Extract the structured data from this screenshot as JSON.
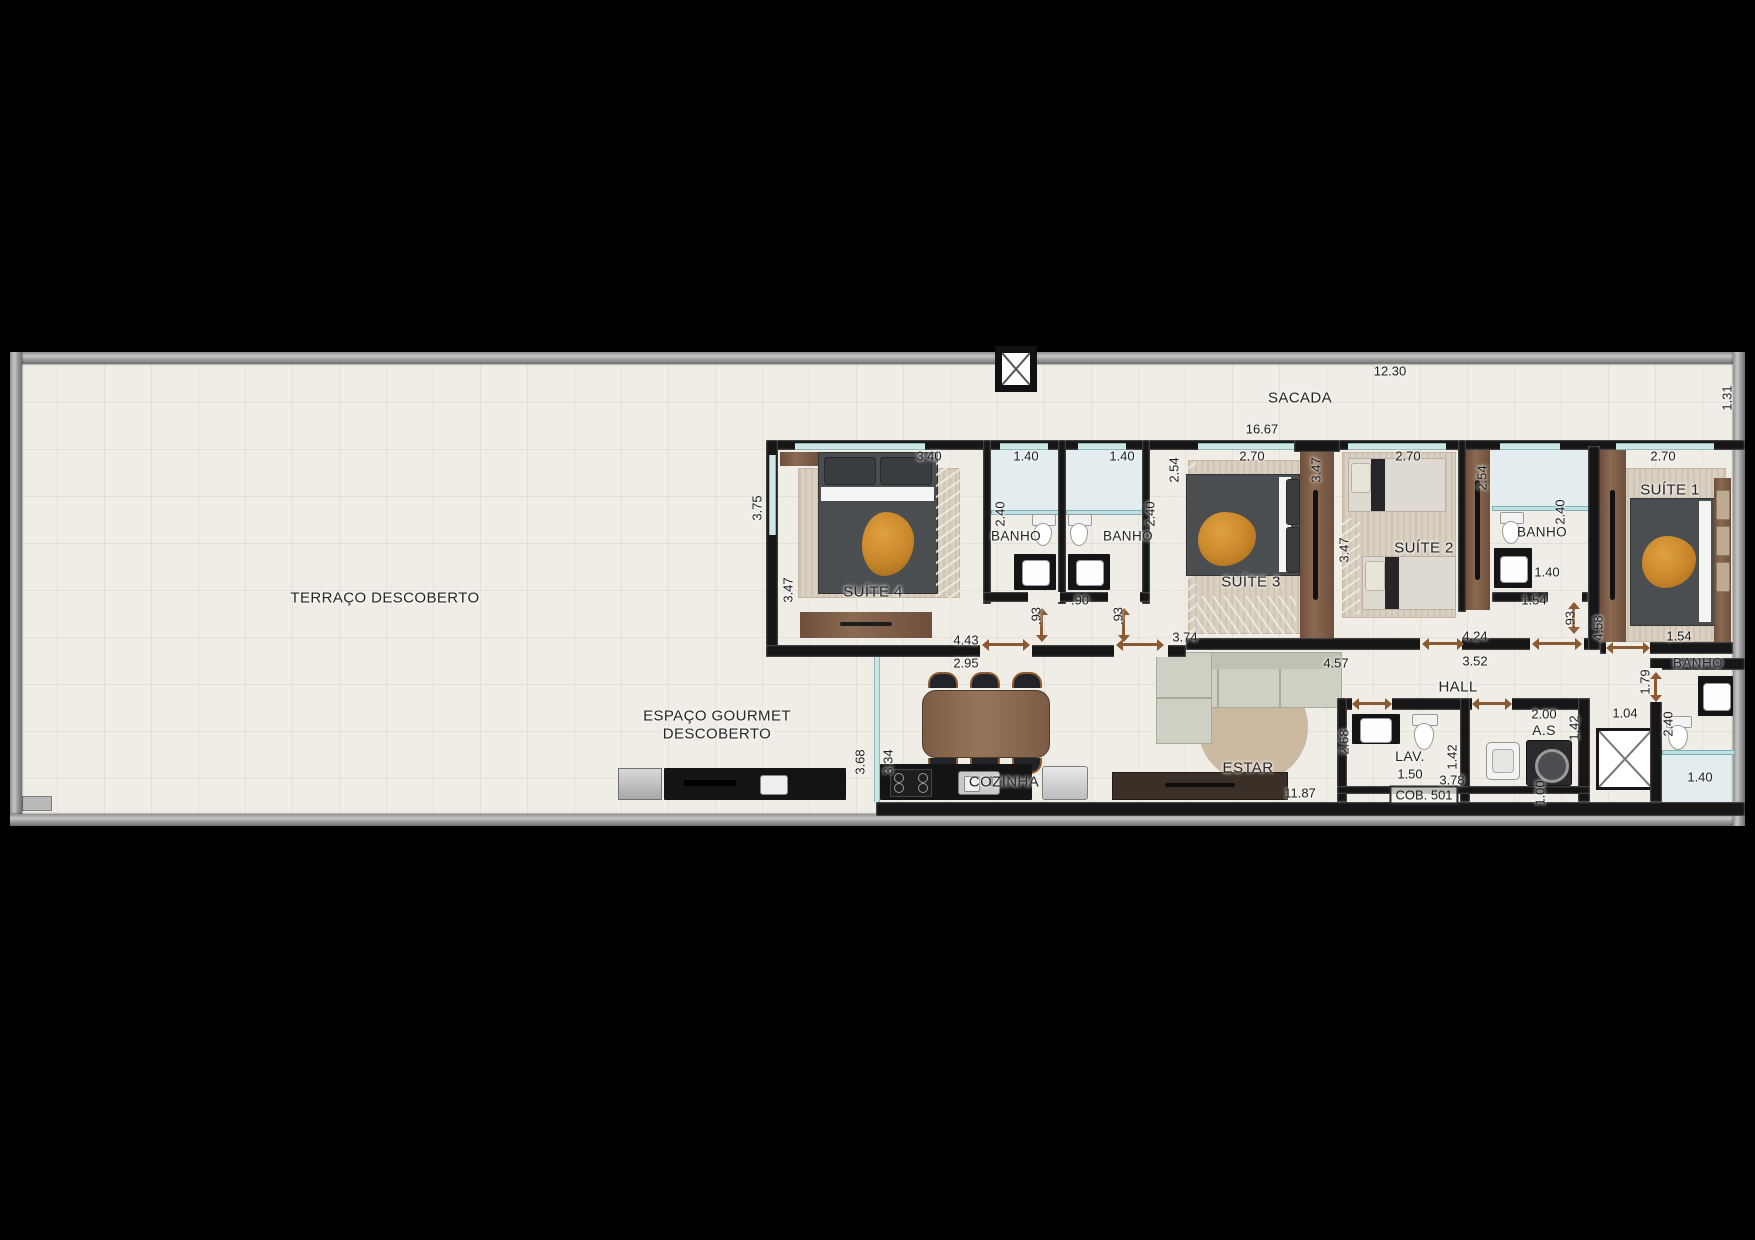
{
  "unit_label": "COB. 501",
  "rooms": {
    "terraco": "TERRAÇO DESCOBERTO",
    "sacada": "SACADA",
    "gourmet1": "ESPAÇO GOURMET",
    "gourmet2": "DESCOBERTO",
    "cozinha": "COZINHA",
    "estar": "ESTAR",
    "hall": "HALL",
    "lav": "LAV.",
    "as": "A.S",
    "banho": "BANHO",
    "suite1": "SUÍTE 1",
    "suite2": "SUÍTE 2",
    "suite3": "SUÍTE 3",
    "suite4": "SUÍTE 4"
  },
  "dims": [
    {
      "id": "sacada_len",
      "value": "12.30"
    },
    {
      "id": "sacada_depth",
      "value": "1.31"
    },
    {
      "id": "apt_width",
      "value": "16.67"
    },
    {
      "id": "s4_w",
      "value": "3.40"
    },
    {
      "id": "b1_w",
      "value": "1.40"
    },
    {
      "id": "b2_w",
      "value": "1.40"
    },
    {
      "id": "s3_w",
      "value": "2.70"
    },
    {
      "id": "s2_w",
      "value": "2.70"
    },
    {
      "id": "s1_w",
      "value": "2.70"
    },
    {
      "id": "b2_wall",
      "value": "2.54"
    },
    {
      "id": "s3_wall",
      "value": "3.47"
    },
    {
      "id": "b3_wall",
      "value": "2.54"
    },
    {
      "id": "s4_d1",
      "value": "3.75"
    },
    {
      "id": "s4_d2",
      "value": "3.47"
    },
    {
      "id": "b1_d",
      "value": "2.40"
    },
    {
      "id": "b2_d",
      "value": "2.40"
    },
    {
      "id": "b3_d",
      "value": "2.40"
    },
    {
      "id": "b3_w2",
      "value": "1.40"
    },
    {
      "id": "s2_wall",
      "value": "3.47"
    },
    {
      "id": "b3_s",
      "value": "1.54"
    },
    {
      "id": "s1_door",
      "value": ".93"
    },
    {
      "id": "wall_458",
      "value": "4.58"
    },
    {
      "id": "s1_s",
      "value": "1.54"
    },
    {
      "id": "br_wall",
      "value": "1.79"
    },
    {
      "id": "br_d",
      "value": "2.40"
    },
    {
      "id": "br_w",
      "value": "1.40"
    },
    {
      "id": "banhos_door",
      "value": ".90"
    },
    {
      "id": "b1_door",
      "value": ".93"
    },
    {
      "id": "b2_door",
      "value": ".93"
    },
    {
      "id": "w443",
      "value": "4.43"
    },
    {
      "id": "w295",
      "value": "2.95"
    },
    {
      "id": "w374",
      "value": "3.74"
    },
    {
      "id": "w457",
      "value": "4.57"
    },
    {
      "id": "w424",
      "value": "4.24"
    },
    {
      "id": "w352",
      "value": "3.52"
    },
    {
      "id": "lav_wall",
      "value": "2.68"
    },
    {
      "id": "lav_r",
      "value": "1.42"
    },
    {
      "id": "lav_w",
      "value": "1.50"
    },
    {
      "id": "as_w",
      "value": "2.00"
    },
    {
      "id": "as_r",
      "value": "1.42"
    },
    {
      "id": "ward_elev",
      "value": "1.04"
    },
    {
      "id": "w378",
      "value": "3.78"
    },
    {
      "id": "w100",
      "value": "1.00"
    },
    {
      "id": "w1187",
      "value": "11.87"
    },
    {
      "id": "gourmet_d",
      "value": "3.68"
    },
    {
      "id": "coz_d",
      "value": "3.34"
    }
  ],
  "colors": {
    "floor": "#f0ede6",
    "wall": "#161616",
    "outer_wall": "#9a9a9a",
    "wood": "#7b5a44",
    "window_glass": "#cfe6e6",
    "bed_dark": "#4b4e50",
    "gold_throw": "#c8862a",
    "sofa": "#cdd0c2",
    "shower": "#e3edef",
    "counter": "#141414"
  }
}
